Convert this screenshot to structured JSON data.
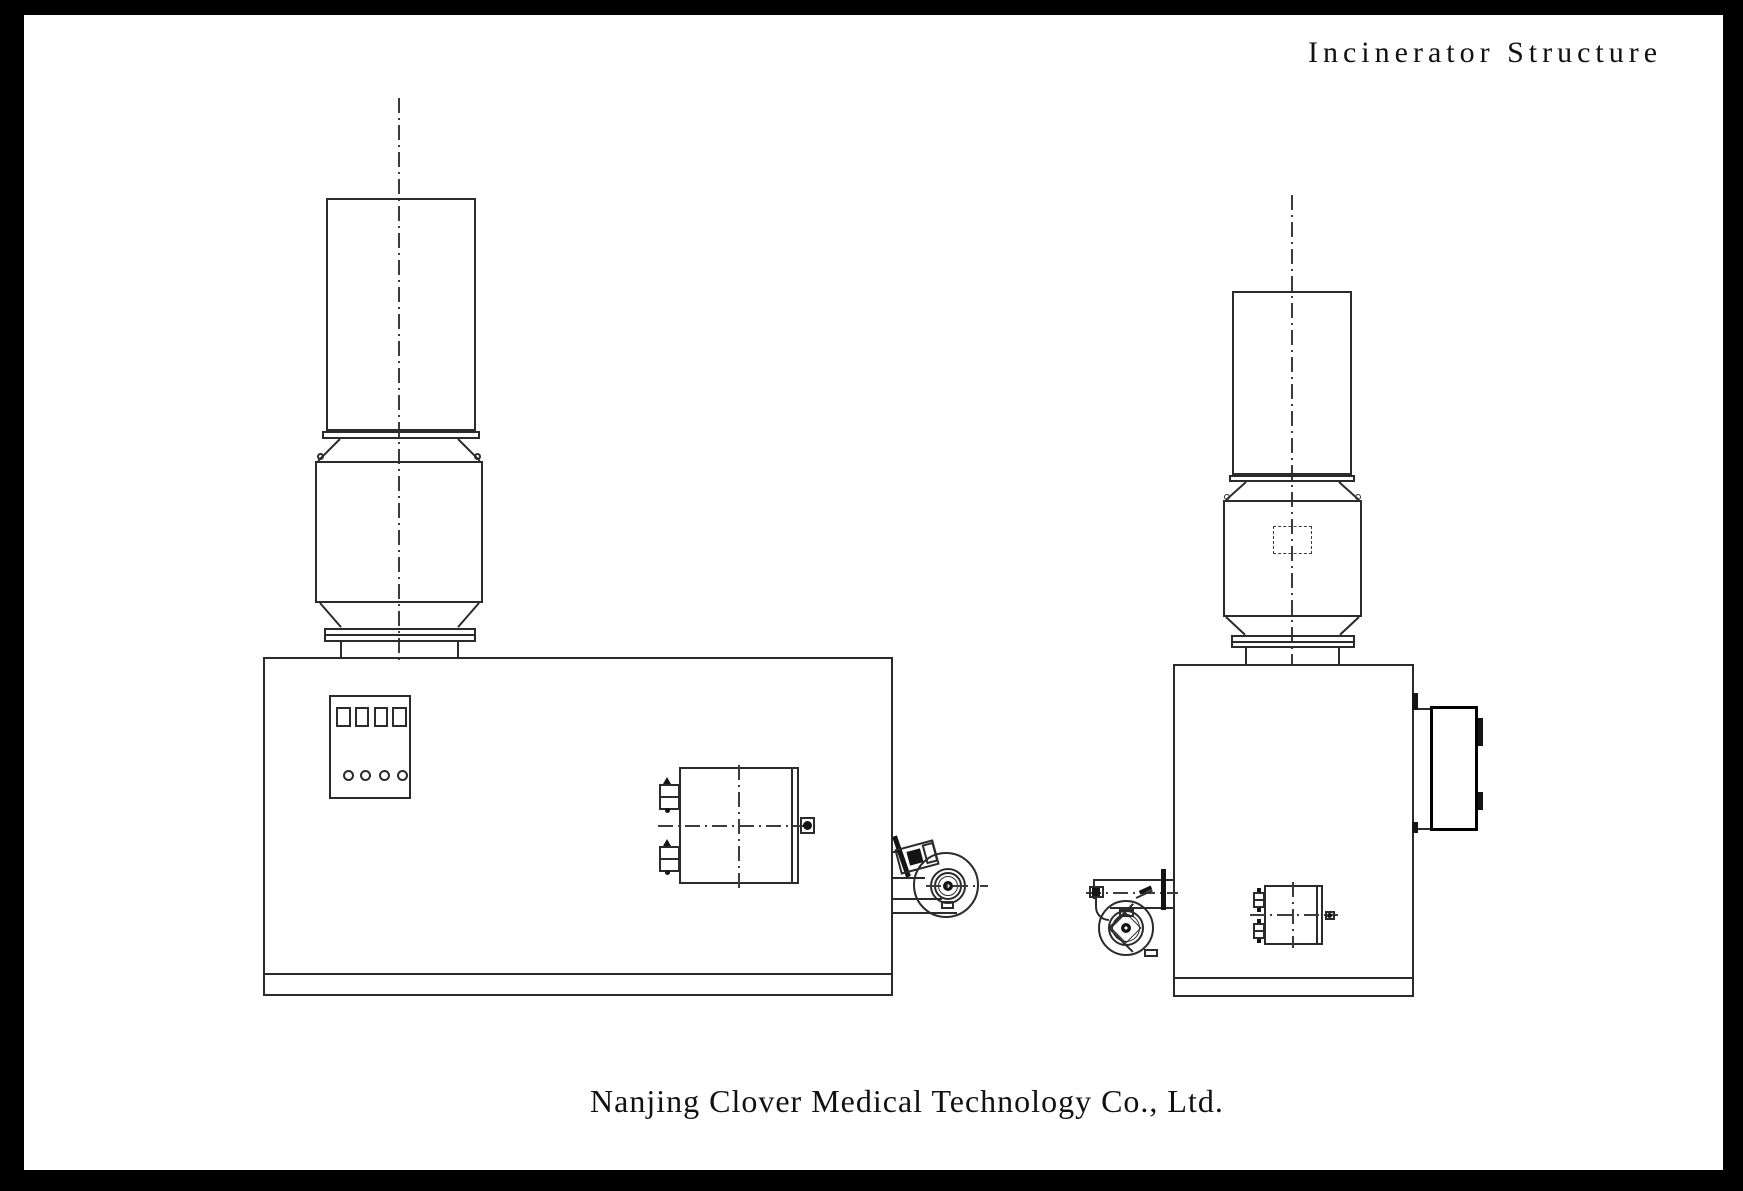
{
  "sheet": {
    "title": "Incinerator Structure",
    "company": "Nanjing Clover Medical Technology Co., Ltd."
  },
  "style": {
    "frame_color": "#000000",
    "paper_color": "#ffffff",
    "line_color": "#2b2b2b",
    "centerline_color": "#3c3c3c",
    "ink_color": "#141414"
  }
}
